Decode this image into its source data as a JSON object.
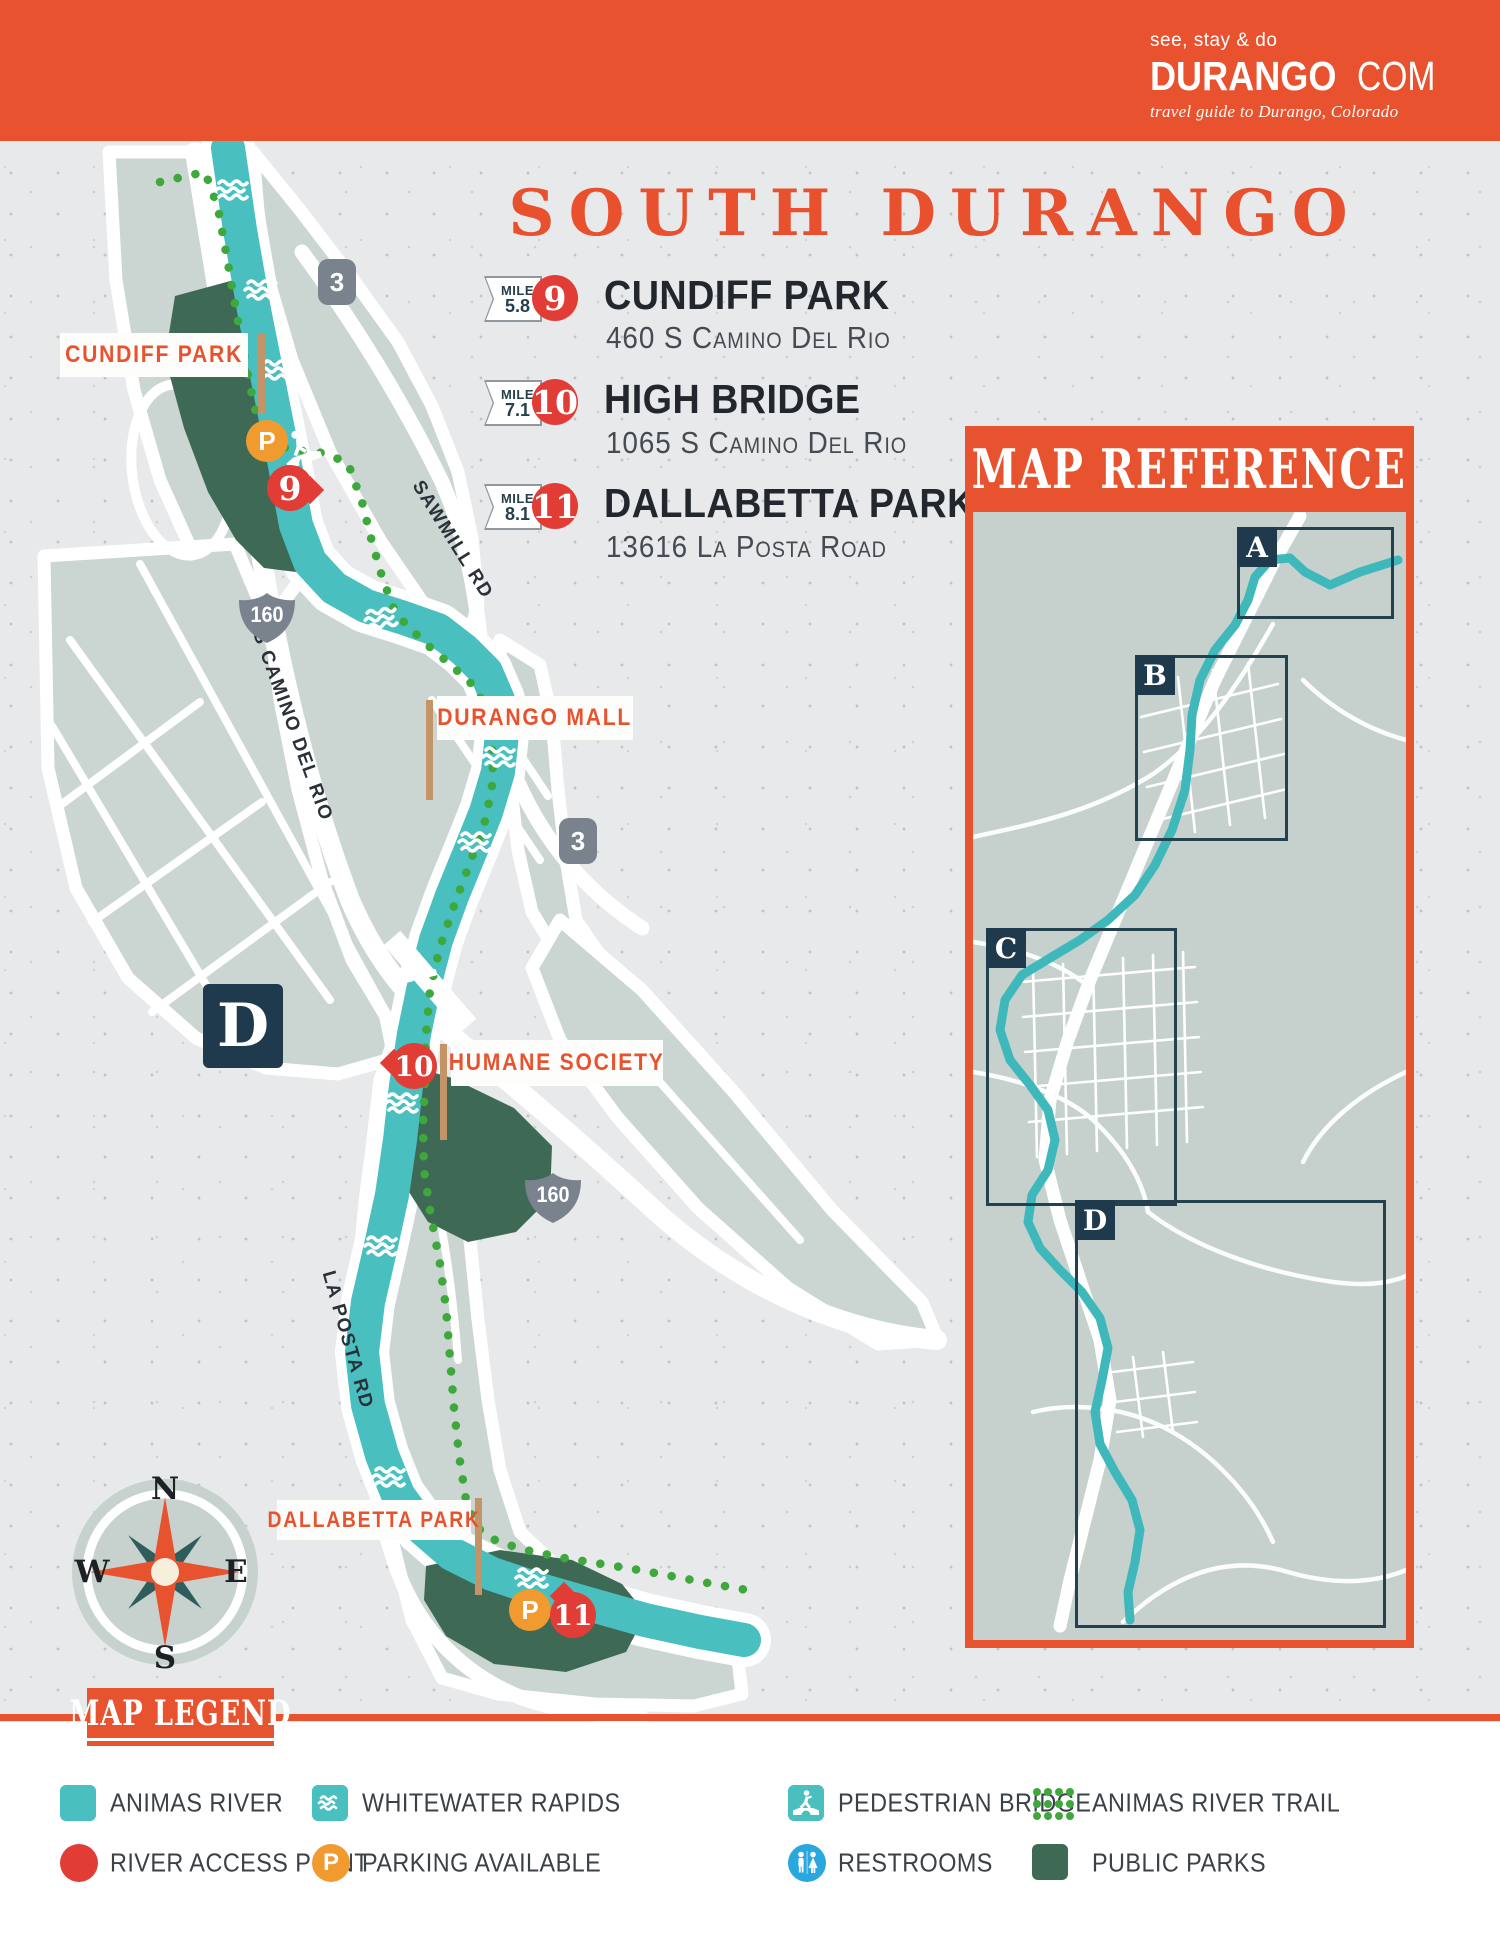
{
  "header": {
    "title": "ANIMAS RIVER ACCESS: DURANGO, CO",
    "logo": {
      "tagline": "see, stay & do",
      "brand": "DURANGO",
      "tld": "COM",
      "subtitle": "travel guide to Durango, Colorado"
    }
  },
  "section_title": "SOUTH DURANGO",
  "access_points": [
    {
      "mile_word": "MILE",
      "mile": "5.8",
      "number": "9",
      "name": "CUNDIFF PARK",
      "address": "460 S Camino Del Rio"
    },
    {
      "mile_word": "MILE",
      "mile": "7.1",
      "number": "10",
      "name": "HIGH BRIDGE",
      "address": "1065 S Camino Del Rio"
    },
    {
      "mile_word": "MILE",
      "mile": "8.1",
      "number": "11",
      "name": "DALLABETTA PARK",
      "address": "13616 La Posta Road"
    }
  ],
  "map": {
    "labels": {
      "cundiff_park": "CUNDIFF PARK",
      "durango_mall": "DURANGO MALL",
      "humane_society": "HUMANE SOCIETY",
      "dallabetta_park": "DALLABETTA PARK"
    },
    "roads": {
      "sawmill": "SAWMILL RD",
      "s_camino_del_rio": "S CAMINO DEL RIO",
      "la_posta": "LA POSTA RD"
    },
    "shields": {
      "route_3": "3",
      "route_160": "160"
    },
    "markers": {
      "m9": "9",
      "m10": "10",
      "m11": "11",
      "parking": "P"
    },
    "section_letter": "D"
  },
  "compass": {
    "n": "N",
    "e": "E",
    "s": "S",
    "w": "W"
  },
  "map_reference": {
    "title": "MAP REFERENCE",
    "boxes": [
      {
        "letter": "A"
      },
      {
        "letter": "B"
      },
      {
        "letter": "C"
      },
      {
        "letter": "D"
      }
    ]
  },
  "legend": {
    "title": "MAP LEGEND",
    "items": [
      {
        "label": "ANIMAS RIVER"
      },
      {
        "label": "WHITEWATER RAPIDS"
      },
      {
        "label": "PEDESTRIAN BRIDGE"
      },
      {
        "label": "ANIMAS RIVER TRAIL"
      },
      {
        "label": "RIVER ACCESS POINT"
      },
      {
        "label": "PARKING AVAILABLE"
      },
      {
        "label": "RESTROOMS"
      },
      {
        "label": "PUBLIC PARKS"
      }
    ]
  },
  "colors": {
    "orange": "#E8532F",
    "red": "#E23C36",
    "river_teal": "#49BFC0",
    "navy": "#1E3A4C",
    "park_green": "#3E6A55",
    "trail_green": "#3EA83C",
    "parking_orange": "#F19A2F",
    "restroom_blue": "#2AA7DF",
    "shield_gray": "#7A838D",
    "block_sage": "#CBD5D1"
  }
}
